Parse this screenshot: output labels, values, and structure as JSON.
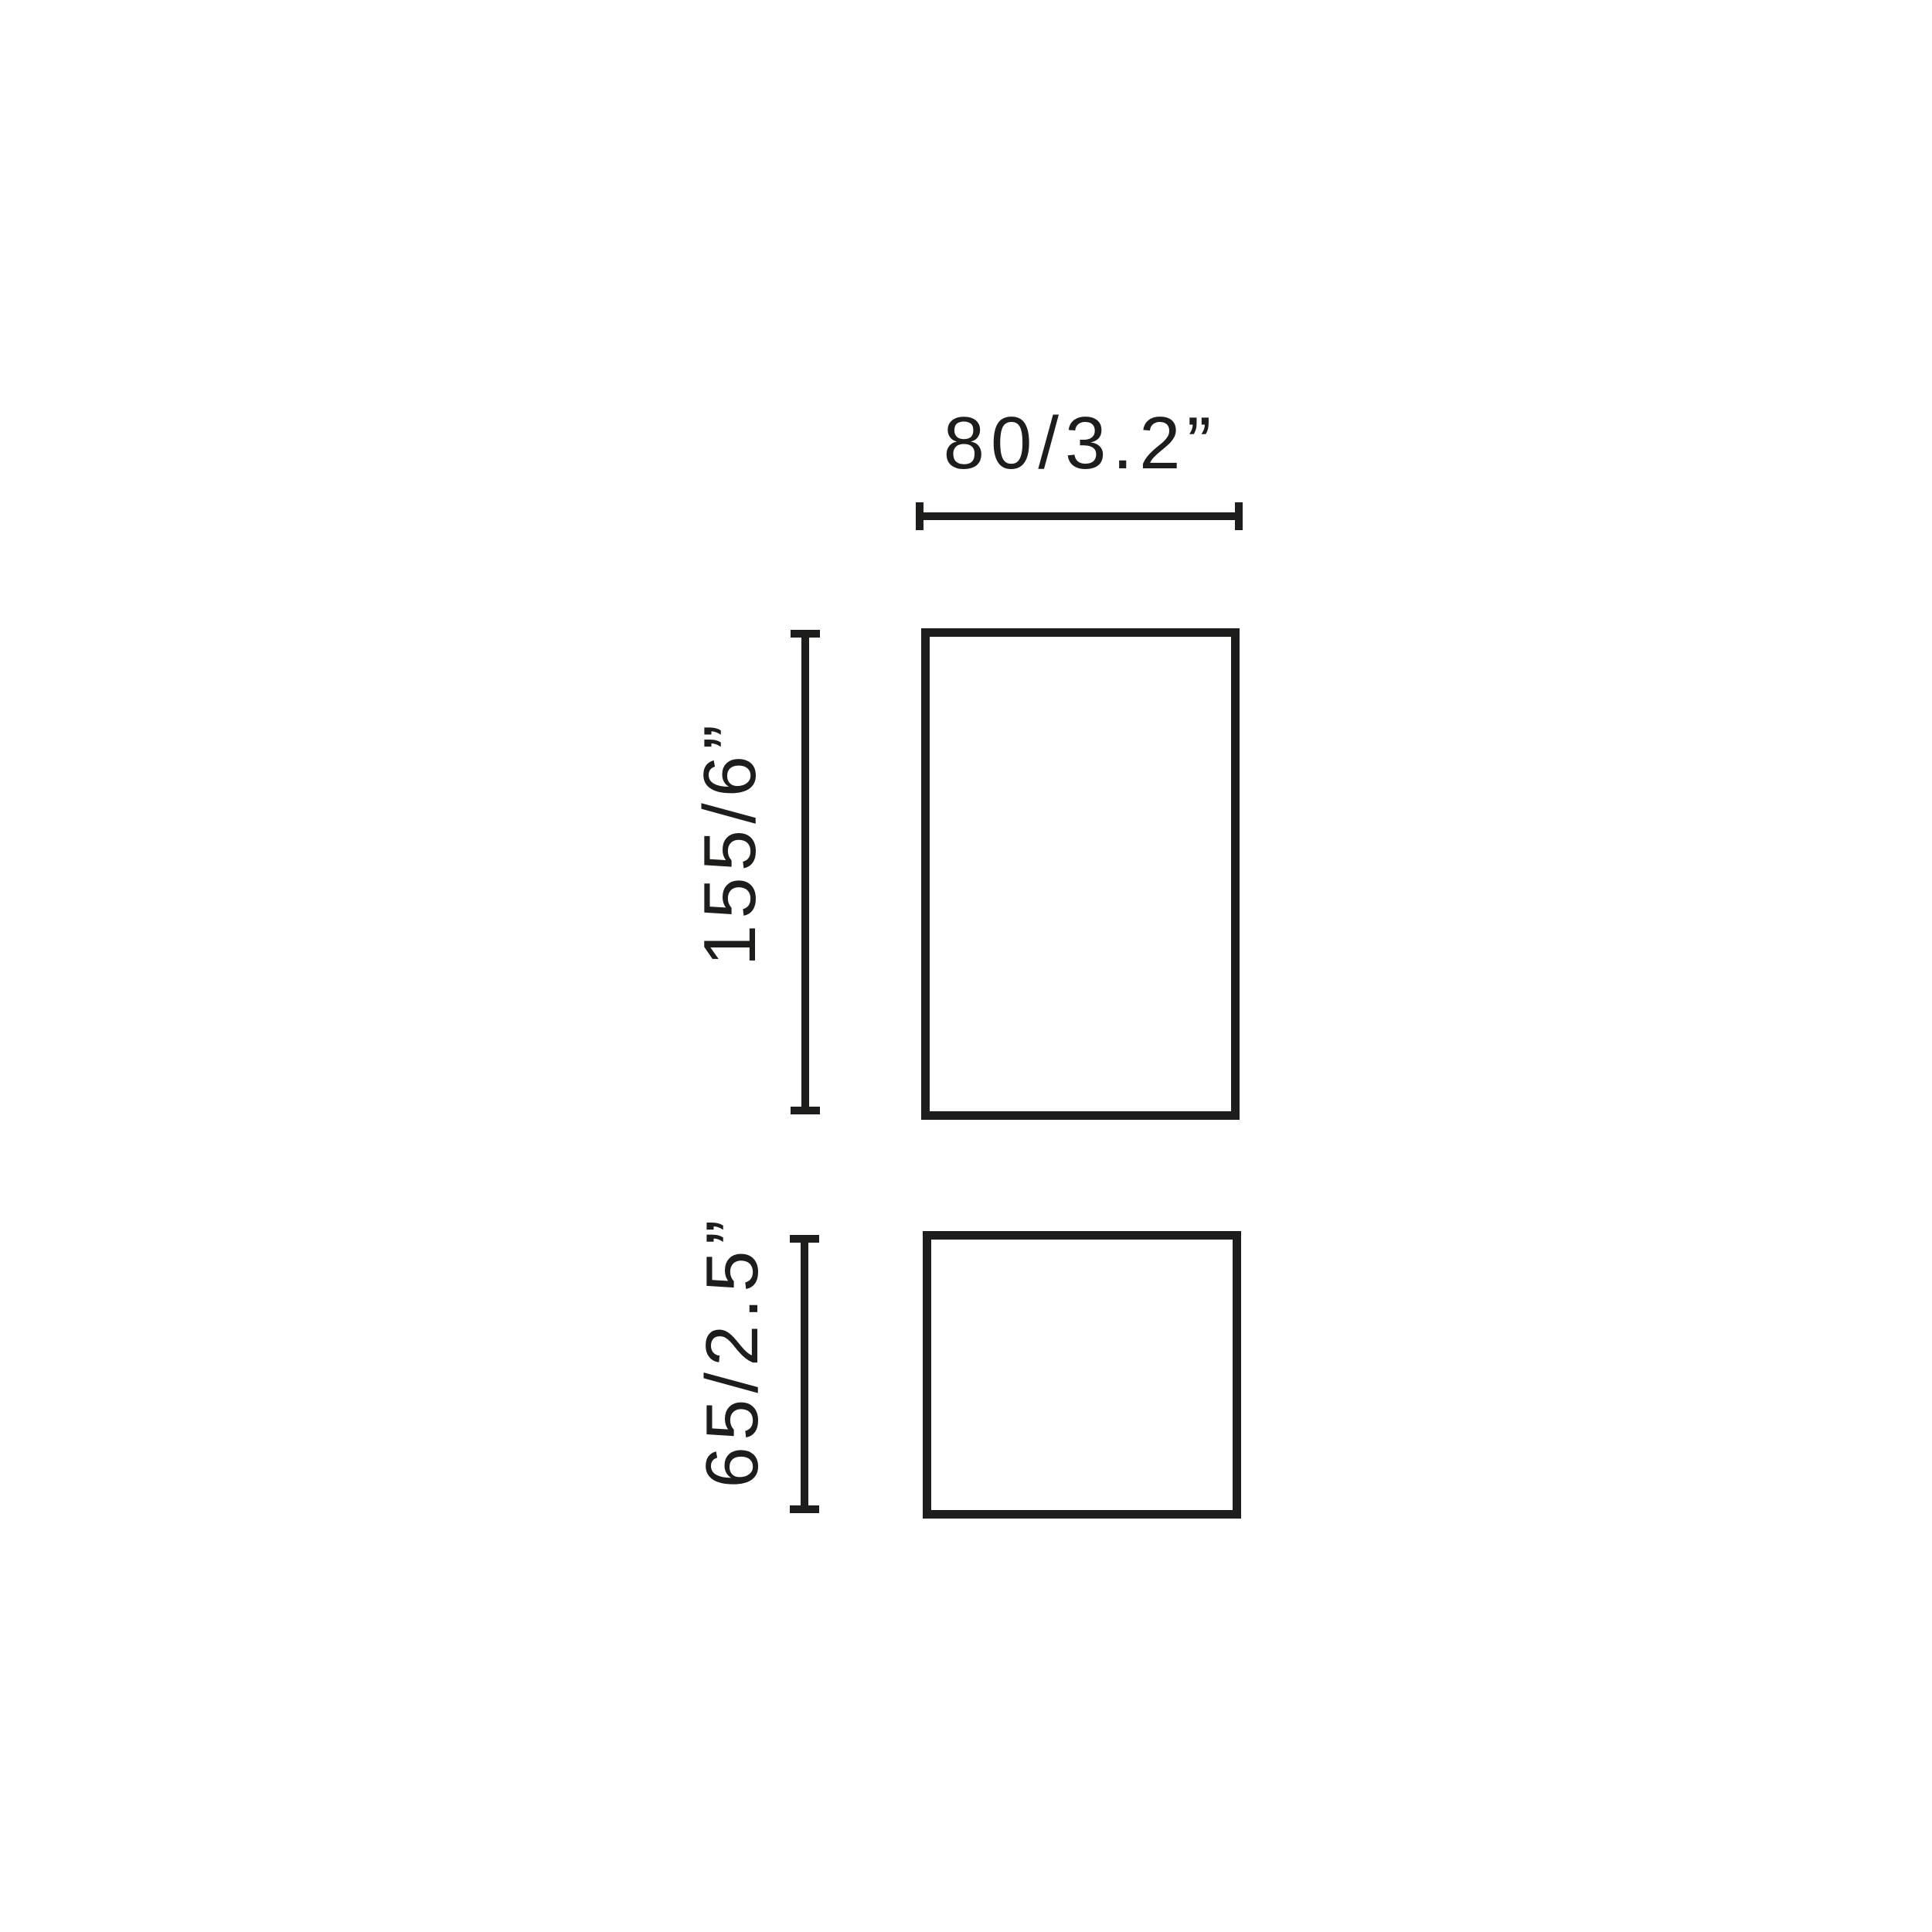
{
  "diagram": {
    "type": "product-dimension-drawing",
    "colors": {
      "background": "#ffffff",
      "line": "#1d1d1b"
    },
    "labels": {
      "width": "80/3.2”",
      "height_upper": "155/6”",
      "height_lower": "65/2.5”"
    }
  }
}
